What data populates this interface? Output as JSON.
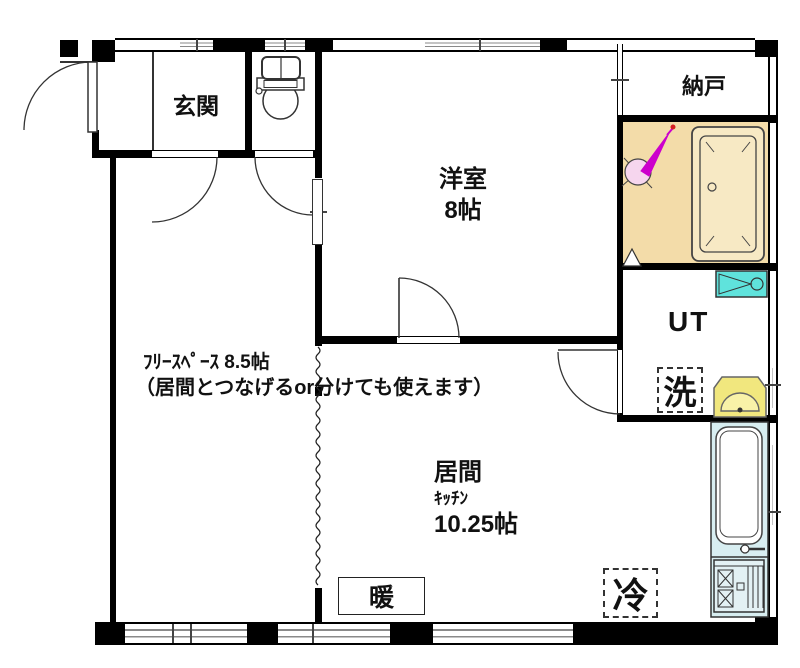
{
  "rooms": {
    "genkan": {
      "label": "玄関"
    },
    "yoshitsu": {
      "label": "洋室",
      "size": "8帖"
    },
    "nando": {
      "label": "納戸"
    },
    "ut": {
      "label": "UT"
    },
    "free_space": {
      "label": "ﾌﾘｰｽﾍﾟｰｽ 8.5帖",
      "note": "（居間とつなげるor分けても使えます）"
    },
    "living": {
      "label": "居間",
      "sub_label": "ｷｯﾁﾝ",
      "size": "10.25帖"
    }
  },
  "fixtures": {
    "washer_label": "洗",
    "fridge_label": "冷",
    "heater_label": "暖"
  },
  "colors": {
    "wall": "#000000",
    "line": "#222222",
    "bath_floor": "#F3DCA9",
    "bathtub": "#F7E9C4",
    "vanity_cyan": "#5FE3DC",
    "basin_yellow": "#F1E77E",
    "kitchen_counter": "#D8EEF1",
    "stove_panel": "#E3F1F4",
    "shower_magenta": "#CC00CC",
    "shower_pink": "#F6D6EE",
    "shower_tip_red": "#D42020"
  }
}
